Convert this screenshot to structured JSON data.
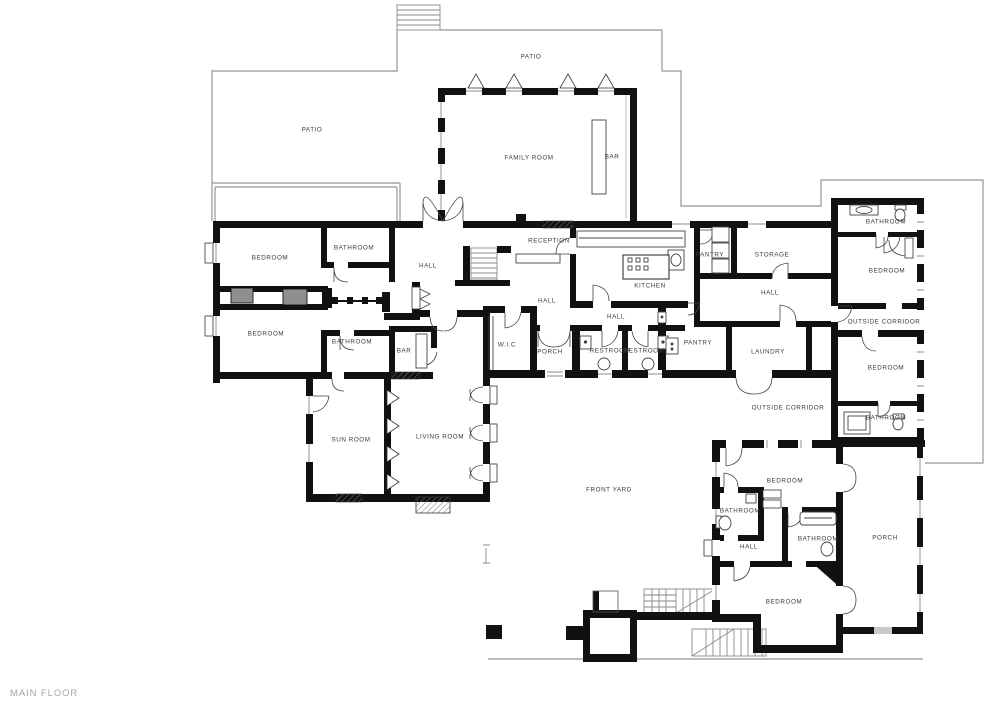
{
  "floor_label": "MAIN FLOOR",
  "colors": {
    "wall": "#111111",
    "boundary": "#a6a6a6",
    "room_label": "#3a3a3a",
    "floor_label": "#a6a6a6",
    "closet_fill": "#8f8f8f",
    "background": "#ffffff"
  },
  "rooms": [
    {
      "id": "patio-top",
      "label": "PATIO"
    },
    {
      "id": "patio-left",
      "label": "PATIO"
    },
    {
      "id": "family-room",
      "label": "FAMILY ROOM"
    },
    {
      "id": "bar-family",
      "label": "BAR"
    },
    {
      "id": "bedroom-nw",
      "label": "BEDROOM"
    },
    {
      "id": "bathroom-nw",
      "label": "BATHROOM"
    },
    {
      "id": "hall-west",
      "label": "HALL"
    },
    {
      "id": "reception",
      "label": "RECEPTION"
    },
    {
      "id": "kitchen",
      "label": "KITCHEN"
    },
    {
      "id": "pantry-upper",
      "label": "PANTRY"
    },
    {
      "id": "storage",
      "label": "STORAGE"
    },
    {
      "id": "hall-northeast",
      "label": "HALL"
    },
    {
      "id": "bedroom-west",
      "label": "BEDROOM"
    },
    {
      "id": "bathroom-west",
      "label": "BATHROOM"
    },
    {
      "id": "bar-nook",
      "label": "BAR"
    },
    {
      "id": "hall-center",
      "label": "HALL"
    },
    {
      "id": "hall-mid",
      "label": "HALL"
    },
    {
      "id": "wic",
      "label": "W.I.C"
    },
    {
      "id": "porch-front",
      "label": "PORCH"
    },
    {
      "id": "restroom-1",
      "label": "RESTROOM"
    },
    {
      "id": "restroom-2",
      "label": "RESTROOM"
    },
    {
      "id": "pantry-lower",
      "label": "PANTRY"
    },
    {
      "id": "laundry",
      "label": "LAUNDRY"
    },
    {
      "id": "sun-room",
      "label": "SUN ROOM"
    },
    {
      "id": "living-room",
      "label": "LIVING ROOM"
    },
    {
      "id": "bathroom-ne",
      "label": "BATHROOM"
    },
    {
      "id": "bedroom-ne",
      "label": "BEDROOM"
    },
    {
      "id": "outside-corridor-ne",
      "label": "OUTSIDE CORRIDOR"
    },
    {
      "id": "bedroom-east",
      "label": "BEDROOM"
    },
    {
      "id": "outside-corridor-east",
      "label": "OUTSIDE CORRIDOR"
    },
    {
      "id": "bathroom-east",
      "label": "BATHROOM"
    },
    {
      "id": "front-yard",
      "label": "FRONT YARD"
    },
    {
      "id": "bedroom-se-upper",
      "label": "BEDROOM"
    },
    {
      "id": "bathroom-se-left",
      "label": "BATHROOM"
    },
    {
      "id": "hall-south",
      "label": "HALL"
    },
    {
      "id": "bathroom-se-center",
      "label": "BATHROOM"
    },
    {
      "id": "porch-se",
      "label": "PORCH"
    },
    {
      "id": "bedroom-se-lower",
      "label": "BEDROOM"
    }
  ]
}
